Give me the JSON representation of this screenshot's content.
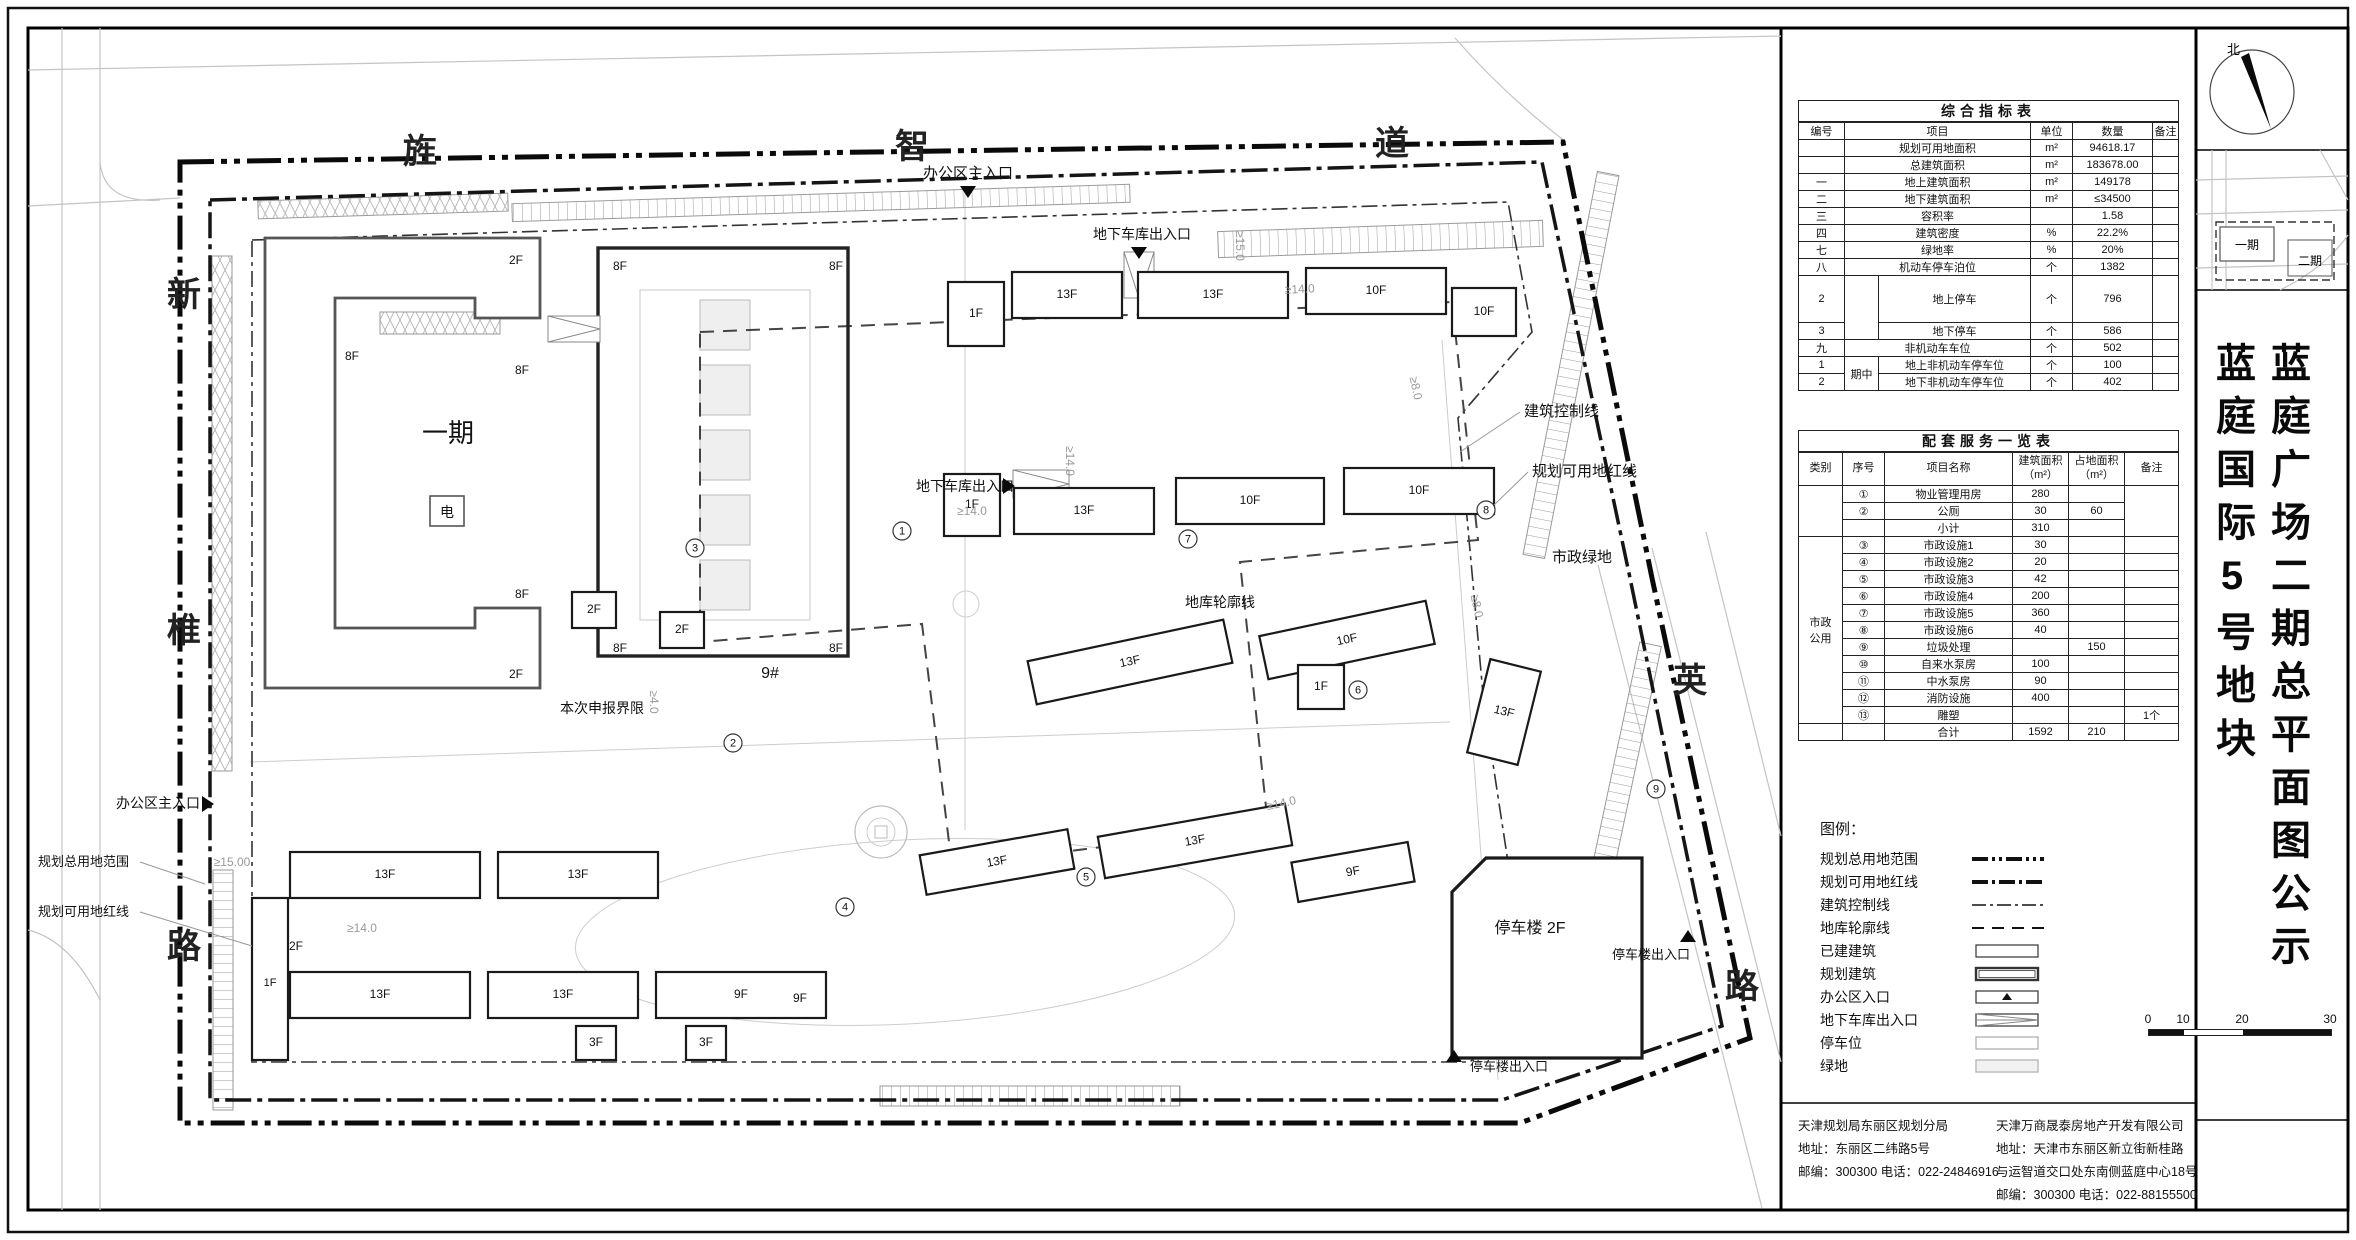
{
  "doc": {
    "title_col_right": "蓝庭广场二期总平面图公示",
    "title_col_left": "蓝庭国际5号地块",
    "north_label": "北",
    "minimap": {
      "phase1": "一期",
      "phase2": "二期"
    }
  },
  "table1": {
    "title": "综合指标表",
    "headers": [
      "编号",
      "项目",
      "单位",
      "数量",
      "备注"
    ],
    "sub_label": "期中",
    "rows": [
      [
        "",
        "规划可用地面积",
        "m²",
        "94618.17",
        ""
      ],
      [
        "",
        "总建筑面积",
        "m²",
        "183678.00",
        ""
      ],
      [
        "一",
        "地上建筑面积",
        "m²",
        "149178",
        ""
      ],
      [
        "二",
        "地下建筑面积",
        "m²",
        "≤34500",
        ""
      ],
      [
        "三",
        "容积率",
        "",
        "1.58",
        ""
      ],
      [
        "四",
        "建筑密度",
        "%",
        "22.2%",
        ""
      ],
      [
        "七",
        "绿地率",
        "%",
        "20%",
        ""
      ],
      [
        "八",
        "机动车停车泊位",
        "个",
        "1382",
        ""
      ],
      [
        "2",
        "地上停车",
        "个",
        "796",
        ""
      ],
      [
        "3",
        "地下停车",
        "个",
        "586",
        ""
      ],
      [
        "九",
        "非机动车车位",
        "个",
        "502",
        ""
      ],
      [
        "1",
        "地上非机动车停车位",
        "个",
        "100",
        ""
      ],
      [
        "2",
        "地下非机动车停车位",
        "个",
        "402",
        ""
      ]
    ]
  },
  "table2": {
    "title": "配套服务一览表",
    "headers": [
      "类别",
      "序号",
      "项目名称",
      "建筑面积\n（m²）",
      "占地面积\n（m²）",
      "备注"
    ],
    "category_label": "市政\n公用",
    "rows": [
      [
        "①",
        "物业管理用房",
        "280",
        "",
        ""
      ],
      [
        "②",
        "公厕",
        "30",
        "60",
        ""
      ],
      [
        "",
        "小计",
        "310",
        "",
        ""
      ],
      [
        "③",
        "市政设施1",
        "30",
        "",
        ""
      ],
      [
        "④",
        "市政设施2",
        "20",
        "",
        ""
      ],
      [
        "⑤",
        "市政设施3",
        "42",
        "",
        ""
      ],
      [
        "⑥",
        "市政设施4",
        "200",
        "",
        ""
      ],
      [
        "⑦",
        "市政设施5",
        "360",
        "",
        ""
      ],
      [
        "⑧",
        "市政设施6",
        "40",
        "",
        ""
      ],
      [
        "⑨",
        "垃圾处理",
        "",
        "150",
        ""
      ],
      [
        "⑩",
        "自来水泵房",
        "100",
        "",
        ""
      ],
      [
        "⑪",
        "中水泵房",
        "90",
        "",
        ""
      ],
      [
        "⑫",
        "消防设施",
        "400",
        "",
        ""
      ],
      [
        "⑬",
        "雕塑",
        "",
        "",
        "1个"
      ],
      [
        "",
        "合计",
        "1592",
        "210",
        ""
      ]
    ]
  },
  "legend": {
    "heading": "图例：",
    "items": [
      {
        "label": "规划总用地范围",
        "type": "line-bold-dashdotdot"
      },
      {
        "label": "规划可用地红线",
        "type": "line-bold-dashdot"
      },
      {
        "label": "建筑控制线",
        "type": "line-thin-dashdot"
      },
      {
        "label": "地库轮廓线",
        "type": "line-dash"
      },
      {
        "label": "已建建筑",
        "type": "box"
      },
      {
        "label": "规划建筑",
        "type": "box-double"
      },
      {
        "label": "办公区入口",
        "type": "box-triangle"
      },
      {
        "label": "地下车库出入口",
        "type": "box-ramp"
      },
      {
        "label": "停车位",
        "type": "box-light"
      },
      {
        "label": "绿地",
        "type": "box-green"
      }
    ],
    "scale_ticks": [
      "0",
      "10",
      "20",
      "30"
    ]
  },
  "contacts": {
    "left": [
      "天津规划局东丽区规划分局",
      "地址：东丽区二纬路5号",
      "邮编：300300  电话：022-24846916"
    ],
    "right": [
      "天津万商晟泰房地产开发有限公司",
      "地址：天津市东丽区新立街新桂路",
      "与运智道交口处东南侧蓝庭中心18号",
      "邮编：300300  电话：022-88155500"
    ]
  },
  "map": {
    "road_chars": [
      {
        "t": "旌",
        "x": 420,
        "y": 163
      },
      {
        "t": "智",
        "x": 912,
        "y": 158
      },
      {
        "t": "道",
        "x": 1392,
        "y": 155
      },
      {
        "t": "新",
        "x": 184,
        "y": 306
      },
      {
        "t": "椎",
        "x": 184,
        "y": 642
      },
      {
        "t": "路",
        "x": 184,
        "y": 958
      },
      {
        "t": "英",
        "x": 1690,
        "y": 692
      },
      {
        "t": "路",
        "x": 1742,
        "y": 998
      }
    ],
    "annotations": [
      {
        "t": "办公区主入口",
        "x": 968,
        "y": 178,
        "s": 15,
        "a": "middle",
        "tri": {
          "x": 968,
          "y": 186,
          "d": "down"
        }
      },
      {
        "t": "地下车库出入口",
        "x": 1142,
        "y": 239,
        "s": 14,
        "a": "middle",
        "tri": {
          "x": 1139,
          "y": 247,
          "d": "down"
        }
      },
      {
        "t": "地下车库出入口",
        "x": 916,
        "y": 491,
        "s": 14,
        "a": "start",
        "tri": {
          "x": 1003,
          "y": 486,
          "d": "right"
        }
      },
      {
        "t": "办公区主入口",
        "x": 116,
        "y": 808,
        "s": 14,
        "a": "start",
        "tri": {
          "x": 202,
          "y": 804,
          "d": "right"
        }
      },
      {
        "t": "规划总用地范围",
        "x": 38,
        "y": 866,
        "s": 13,
        "a": "start",
        "leader": "140,862 205,884"
      },
      {
        "t": "规划可用地红线",
        "x": 38,
        "y": 916,
        "s": 13,
        "a": "start",
        "leader": "140,912 252,946"
      },
      {
        "t": "建筑控制线",
        "x": 1524,
        "y": 416,
        "s": 15,
        "a": "start",
        "leader": "1520,412 1460,452"
      },
      {
        "t": "规划可用地红线",
        "x": 1532,
        "y": 476,
        "s": 15,
        "a": "start",
        "leader": "1528,472 1494,505"
      },
      {
        "t": "市政绿地",
        "x": 1552,
        "y": 562,
        "s": 15,
        "a": "start"
      },
      {
        "t": "地库轮廓线",
        "x": 1185,
        "y": 607,
        "s": 14,
        "a": "start"
      },
      {
        "t": "本次申报界限",
        "x": 560,
        "y": 713,
        "s": 14,
        "a": "start"
      },
      {
        "t": "停车楼出入口",
        "x": 1612,
        "y": 959,
        "s": 13,
        "a": "start",
        "tri": {
          "x": 1688,
          "y": 942,
          "d": "up"
        }
      },
      {
        "t": "停车楼出入口",
        "x": 1470,
        "y": 1071,
        "s": 13,
        "a": "start",
        "tri": {
          "x": 1454,
          "y": 1062,
          "d": "up"
        }
      },
      {
        "t": "停车楼 2F",
        "x": 1530,
        "y": 933,
        "s": 16,
        "a": "middle"
      },
      {
        "t": "一期",
        "x": 448,
        "y": 442,
        "s": 26,
        "a": "middle"
      },
      {
        "t": "电",
        "x": 447,
        "y": 517,
        "s": 14,
        "a": "middle"
      },
      {
        "t": "9#",
        "x": 770,
        "y": 678,
        "s": 16,
        "a": "middle"
      },
      {
        "t": "8F",
        "x": 352,
        "y": 360,
        "s": 12,
        "a": "middle"
      },
      {
        "t": "8F",
        "x": 522,
        "y": 374,
        "s": 12,
        "a": "middle"
      },
      {
        "t": "8F",
        "x": 522,
        "y": 598,
        "s": 12,
        "a": "middle"
      },
      {
        "t": "2F",
        "x": 516,
        "y": 264,
        "s": 12,
        "a": "middle"
      },
      {
        "t": "2F",
        "x": 516,
        "y": 678,
        "s": 12,
        "a": "middle"
      },
      {
        "t": "8F",
        "x": 620,
        "y": 270,
        "s": 12,
        "a": "middle"
      },
      {
        "t": "8F",
        "x": 836,
        "y": 270,
        "s": 12,
        "a": "middle"
      },
      {
        "t": "8F",
        "x": 620,
        "y": 652,
        "s": 12,
        "a": "middle"
      },
      {
        "t": "8F",
        "x": 836,
        "y": 652,
        "s": 12,
        "a": "middle"
      },
      {
        "t": "9F",
        "x": 800,
        "y": 1002,
        "s": 12,
        "a": "middle"
      },
      {
        "t": "2F",
        "x": 296,
        "y": 950,
        "s": 12,
        "a": "middle"
      },
      {
        "t": "1F",
        "x": 270,
        "y": 986,
        "s": 11,
        "a": "middle"
      },
      {
        "t": "≥15.00",
        "x": 232,
        "y": 866,
        "s": 12,
        "a": "middle",
        "gray": true
      },
      {
        "t": "≥15.0",
        "x": 1236,
        "y": 246,
        "s": 12,
        "a": "middle",
        "rot": 90,
        "gray": true
      },
      {
        "t": "≥14.0",
        "x": 1300,
        "y": 293,
        "s": 12,
        "a": "middle",
        "rot": -3,
        "gray": true
      },
      {
        "t": "≥14.0",
        "x": 1066,
        "y": 461,
        "s": 12,
        "a": "middle",
        "rot": 90,
        "gray": true
      },
      {
        "t": "≥14.0",
        "x": 972,
        "y": 515,
        "s": 12,
        "a": "middle",
        "gray": true
      },
      {
        "t": "≥8.0",
        "x": 1412,
        "y": 389,
        "s": 12,
        "a": "middle",
        "rot": 78,
        "gray": true
      },
      {
        "t": "≥8.0",
        "x": 1473,
        "y": 607,
        "s": 12,
        "a": "middle",
        "rot": 78,
        "gray": true
      },
      {
        "t": "≥14.0",
        "x": 1282,
        "y": 807,
        "s": 12,
        "a": "middle",
        "rot": -12,
        "gray": true
      },
      {
        "t": "≥14.0",
        "x": 362,
        "y": 932,
        "s": 12,
        "a": "middle",
        "gray": true
      },
      {
        "t": "≥4.0",
        "x": 650,
        "y": 702,
        "s": 12,
        "a": "middle",
        "rot": 90,
        "gray": true
      }
    ],
    "circled": [
      {
        "n": "①",
        "x": 902,
        "y": 531
      },
      {
        "n": "②",
        "x": 733,
        "y": 743
      },
      {
        "n": "③",
        "x": 695,
        "y": 548
      },
      {
        "n": "④",
        "x": 845,
        "y": 907
      },
      {
        "n": "⑤",
        "x": 1086,
        "y": 877
      },
      {
        "n": "⑥",
        "x": 1358,
        "y": 690
      },
      {
        "n": "⑦",
        "x": 1188,
        "y": 539
      },
      {
        "n": "⑧",
        "x": 1486,
        "y": 510
      },
      {
        "n": "⑨",
        "x": 1656,
        "y": 789
      }
    ],
    "buildings": [
      {
        "x": 948,
        "y": 282,
        "w": 56,
        "h": 64,
        "label": "1F"
      },
      {
        "x": 1012,
        "y": 272,
        "w": 110,
        "h": 46,
        "label": "13F"
      },
      {
        "x": 1138,
        "y": 272,
        "w": 150,
        "h": 46,
        "label": "13F"
      },
      {
        "x": 1306,
        "y": 268,
        "w": 140,
        "h": 46,
        "label": "10F"
      },
      {
        "x": 1452,
        "y": 288,
        "w": 64,
        "h": 48,
        "label": "10F"
      },
      {
        "x": 944,
        "y": 474,
        "w": 56,
        "h": 62,
        "label": "1F"
      },
      {
        "x": 1014,
        "y": 488,
        "w": 140,
        "h": 46,
        "label": "13F"
      },
      {
        "x": 1176,
        "y": 478,
        "w": 148,
        "h": 46,
        "label": "10F"
      },
      {
        "x": 1344,
        "y": 468,
        "w": 150,
        "h": 46,
        "label": "10F"
      },
      {
        "x": 1030,
        "y": 640,
        "w": 200,
        "h": 44,
        "rot": -12,
        "label": "13F"
      },
      {
        "x": 1262,
        "y": 618,
        "w": 170,
        "h": 44,
        "rot": -12,
        "label": "10F"
      },
      {
        "x": 1478,
        "y": 664,
        "w": 52,
        "h": 96,
        "rot": 14,
        "label": "13F"
      },
      {
        "x": 1298,
        "y": 665,
        "w": 46,
        "h": 44,
        "label": "1F"
      },
      {
        "x": 1100,
        "y": 820,
        "w": 190,
        "h": 42,
        "rot": -10,
        "label": "13F"
      },
      {
        "x": 922,
        "y": 842,
        "w": 150,
        "h": 40,
        "rot": -10,
        "label": "13F"
      },
      {
        "x": 1294,
        "y": 852,
        "w": 118,
        "h": 40,
        "rot": -10,
        "label": "9F"
      },
      {
        "x": 572,
        "y": 592,
        "w": 44,
        "h": 36,
        "label": "2F"
      },
      {
        "x": 660,
        "y": 612,
        "w": 44,
        "h": 36,
        "label": "2F"
      },
      {
        "x": 252,
        "y": 898,
        "w": 36,
        "h": 162,
        "label": ""
      },
      {
        "x": 290,
        "y": 852,
        "w": 190,
        "h": 46,
        "label": "13F"
      },
      {
        "x": 498,
        "y": 852,
        "w": 160,
        "h": 46,
        "label": "13F"
      },
      {
        "x": 290,
        "y": 972,
        "w": 180,
        "h": 46,
        "label": "13F"
      },
      {
        "x": 488,
        "y": 972,
        "w": 150,
        "h": 46,
        "label": "13F"
      },
      {
        "x": 656,
        "y": 972,
        "w": 170,
        "h": 46,
        "label": "9F"
      },
      {
        "x": 576,
        "y": 1026,
        "w": 40,
        "h": 34,
        "label": "3F"
      },
      {
        "x": 686,
        "y": 1026,
        "w": 40,
        "h": 34,
        "label": "3F"
      }
    ]
  }
}
